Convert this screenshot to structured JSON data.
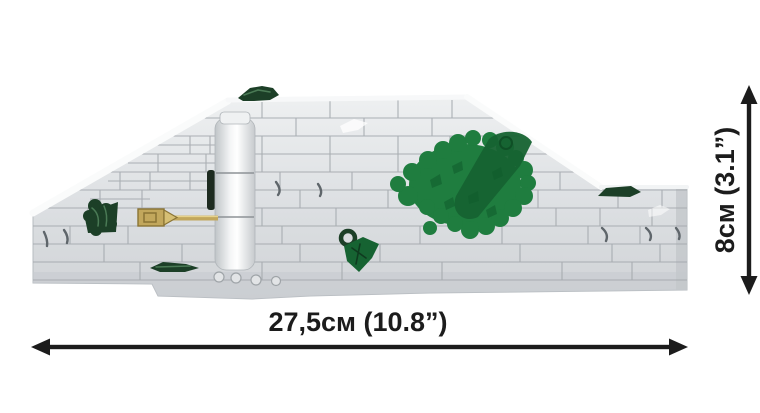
{
  "figure": {
    "alt": "Side view of a light gray brick wall section with green foliage pieces and a gold lever, shown with dimension arrows"
  },
  "dimensions": {
    "width_label": "27,5см (10.8”)",
    "height_label": "8см (3.1”)"
  },
  "colors": {
    "background": "#ffffff",
    "brick_light": "#eceeef",
    "brick_mid": "#d4d7da",
    "brick_shadow": "#c7cbcf",
    "seam": "#a3a8ad",
    "crack": "#5f666b",
    "foliage_bright": "#1f7d3f",
    "foliage_mid": "#166332",
    "foliage_dark": "#1c3f27",
    "gold": "#c2a75c",
    "gold_dark": "#8a7435",
    "annotation": "#1c1c1c"
  }
}
